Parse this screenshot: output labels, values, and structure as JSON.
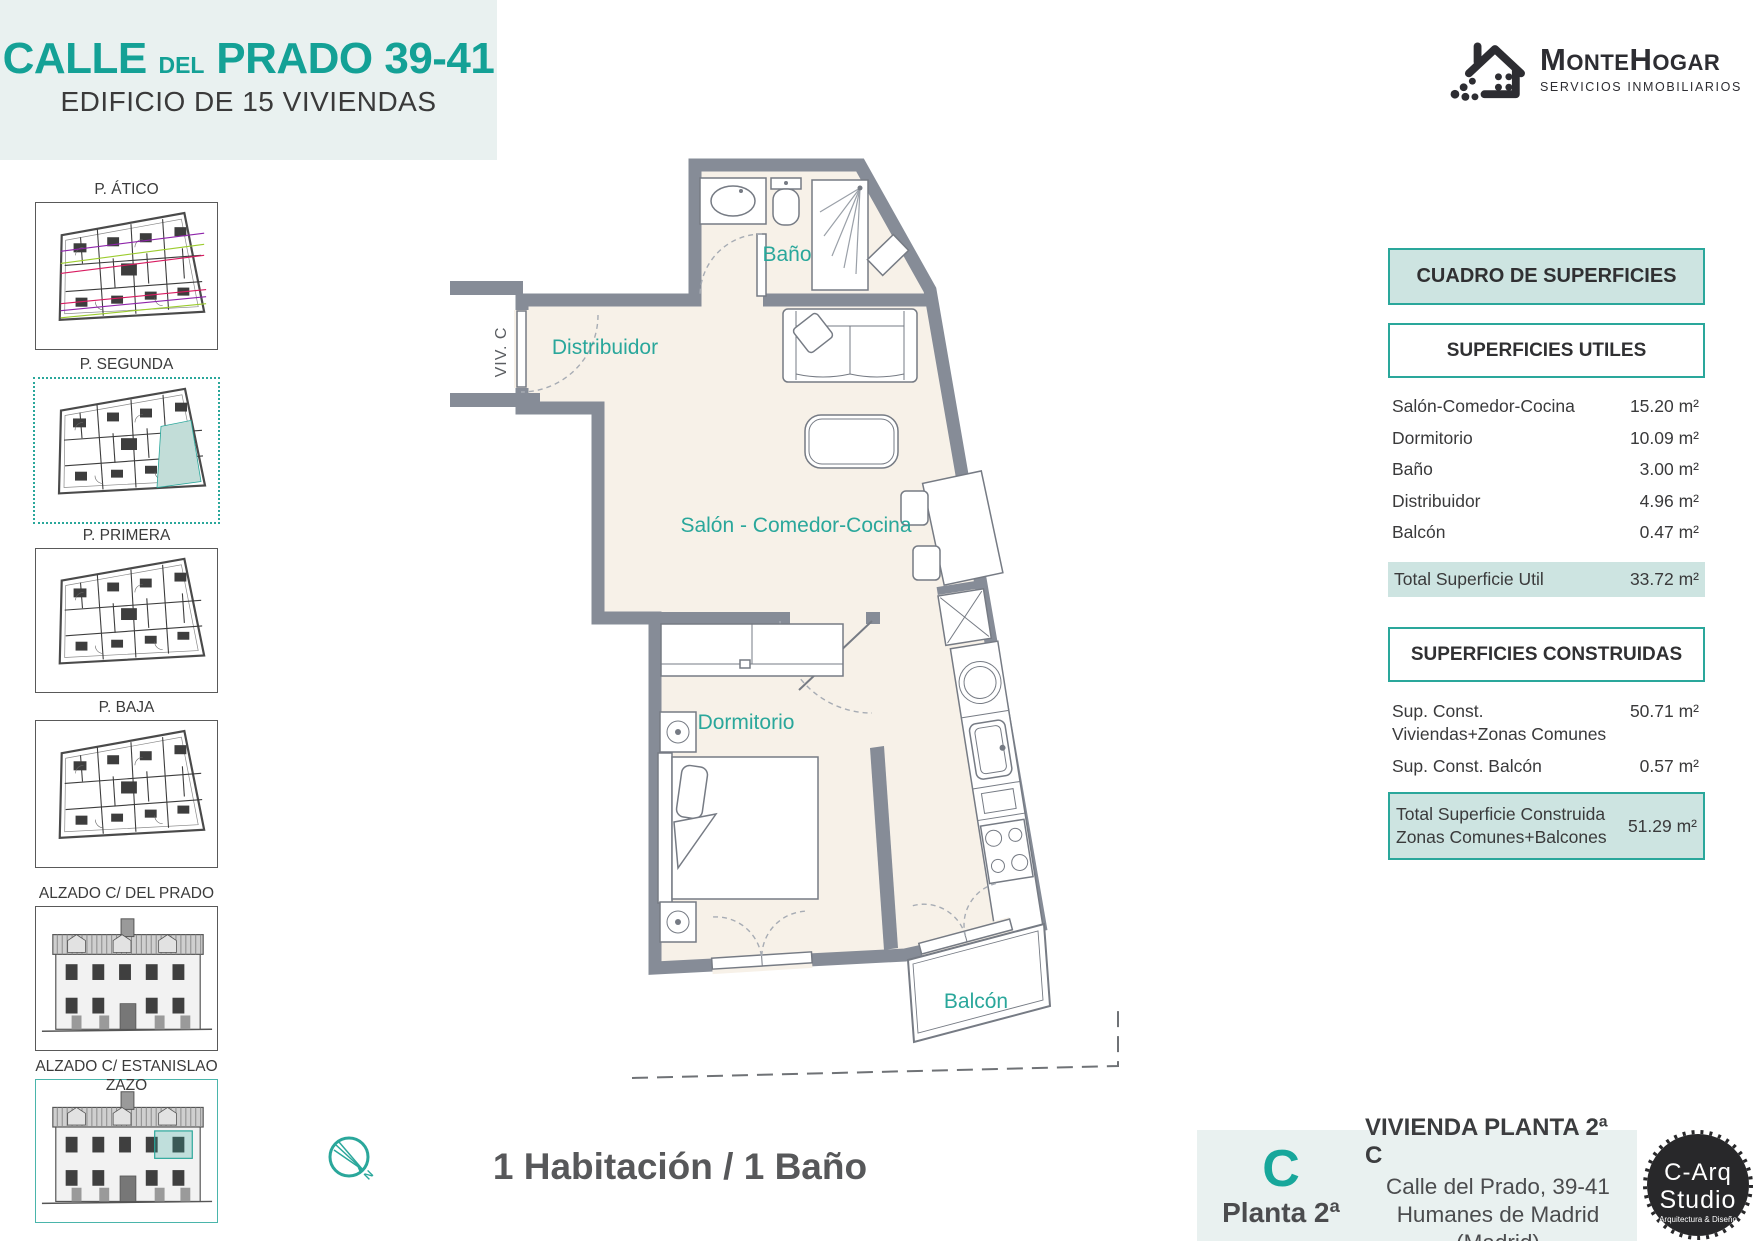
{
  "colors": {
    "accent_teal": "#17a79b",
    "border_teal": "#2aa79b",
    "table_teal_bg": "#cde4e1",
    "wall_gray": "#868c97",
    "floor_beige": "#f7f1e8",
    "header_bg": "#e9f1f0"
  },
  "header": {
    "title_calle": "CALLE",
    "title_del": "DEL",
    "title_prado": "PRADO 39-41",
    "subtitle": "EDIFICIO DE 15 VIVIENDAS"
  },
  "brand": {
    "name_part1": "Monte",
    "name_part2": "Hogar",
    "tagline": "SERVICIOS INMOBILIARIOS"
  },
  "sidebar": {
    "items": [
      {
        "label": "P. ÁTICO",
        "selected": false
      },
      {
        "label": "P. SEGUNDA",
        "selected": true
      },
      {
        "label": "P. PRIMERA",
        "selected": false
      },
      {
        "label": "P. BAJA",
        "selected": false
      },
      {
        "label": "ALZADO C/ DEL PRADO",
        "selected": false
      },
      {
        "label": "ALZADO C/ ESTANISLAO ZAZO",
        "selected": false
      }
    ]
  },
  "plan": {
    "unit_label": "VIV. C",
    "labels": {
      "bano": "Baño",
      "distribuidor": "Distribuidor",
      "salon": "Salón - Comedor-Cocina",
      "dormitorio": "Dormitorio",
      "balcon": "Balcón"
    }
  },
  "surfaces": {
    "title": "CUADRO DE SUPERFICIES",
    "utiles": {
      "title": "SUPERFICIES UTILES",
      "rows": [
        {
          "label": "Salón-Comedor-Cocina",
          "value": "15.20 m²"
        },
        {
          "label": "Dormitorio",
          "value": "10.09 m²"
        },
        {
          "label": "Baño",
          "value": "3.00 m²"
        },
        {
          "label": "Distribuidor",
          "value": "4.96 m²"
        },
        {
          "label": "Balcón",
          "value": "0.47 m²"
        }
      ],
      "total": {
        "label": "Total Superficie Util",
        "value": "33.72 m²"
      }
    },
    "construidas": {
      "title": "SUPERFICIES CONSTRUIDAS",
      "rows": [
        {
          "label": "Sup. Const. Viviendas+Zonas Comunes",
          "value": "50.71 m²"
        },
        {
          "label": "Sup. Const. Balcón",
          "value": "0.57 m²"
        }
      ],
      "total": {
        "label_line1": "Total Superficie Construida",
        "label_line2": "Zonas Comunes+Balcones",
        "value": "51.29 m²"
      }
    }
  },
  "footer": {
    "summary": "1 Habitación / 1 Baño",
    "unit_letter": "C",
    "floor_label": "Planta 2ª",
    "dwelling_title": "VIVIENDA PLANTA 2ª C",
    "address_line1": "Calle del Prado, 39-41",
    "address_line2": "Humanes de Madrid (Madrid)"
  },
  "studio_logo": {
    "line1": "C-Arq",
    "line2": "Studio",
    "line3": "Arquitectura & Diseño"
  },
  "compass": {
    "north_label": "N"
  }
}
